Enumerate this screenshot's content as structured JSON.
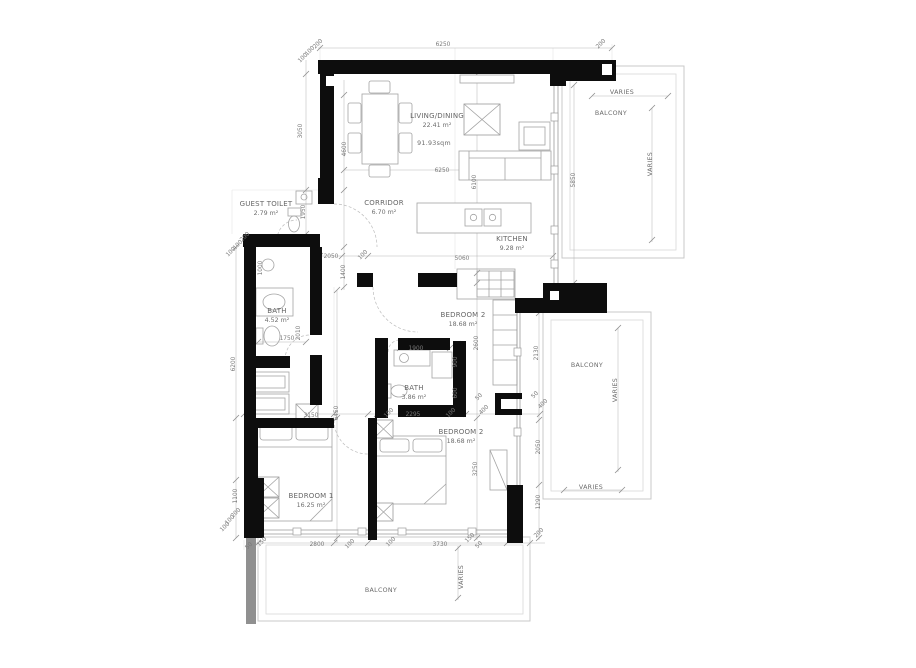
{
  "plan": {
    "title": "apartment-floor-plan",
    "colors": {
      "wall": "#0d0d0d",
      "secondary_wall": "#909090",
      "drawing_line": "#9b9b9b",
      "text": "#6b6b6b",
      "background": "#ffffff"
    },
    "rooms": [
      {
        "id": "living-dining",
        "name": "LIVING/DINING",
        "area": "22.41 m²",
        "x": 437,
        "y": 118
      },
      {
        "id": "corridor",
        "name": "CORRIDOR",
        "area": "6.70 m²",
        "x": 384,
        "y": 205
      },
      {
        "id": "guest-toilet",
        "name": "GUEST TOILET",
        "area": "2.79 m²",
        "x": 266,
        "y": 206
      },
      {
        "id": "kitchen",
        "name": "KITCHEN",
        "area": "9.28 m²",
        "x": 512,
        "y": 241
      },
      {
        "id": "bath-1",
        "name": "BATH",
        "area": "4.52 m²",
        "x": 277,
        "y": 313
      },
      {
        "id": "bath-2",
        "name": "BATH",
        "area": "3.86 m²",
        "x": 414,
        "y": 390
      },
      {
        "id": "bedroom-2-upper",
        "name": "BEDROOM 2",
        "area": "18.68 m²",
        "x": 463,
        "y": 317
      },
      {
        "id": "bedroom-2",
        "name": "BEDROOM 2",
        "area": "18.68 m²",
        "x": 461,
        "y": 434
      },
      {
        "id": "bedroom-1",
        "name": "BEDROOM 1",
        "area": "16.25 m²",
        "x": 311,
        "y": 498
      }
    ],
    "annotations": [
      {
        "id": "total-area",
        "text": "91.93sqm",
        "x": 434,
        "y": 145,
        "r": 0
      },
      {
        "id": "balcony-top-right",
        "text": "BALCONY",
        "x": 611,
        "y": 115,
        "r": 0
      },
      {
        "id": "balcony-right",
        "text": "BALCONY",
        "x": 587,
        "y": 367,
        "r": 0
      },
      {
        "id": "balcony-bottom",
        "text": "BALCONY",
        "x": 381,
        "y": 592,
        "r": 0
      },
      {
        "id": "varies-1",
        "text": "VARIES",
        "x": 622,
        "y": 94,
        "r": 0
      },
      {
        "id": "varies-2",
        "text": "VARIES",
        "x": 652,
        "y": 164,
        "r": -90
      },
      {
        "id": "varies-3",
        "text": "VARIES",
        "x": 617,
        "y": 390,
        "r": -90
      },
      {
        "id": "varies-4",
        "text": "VARIES",
        "x": 591,
        "y": 489,
        "r": 0
      },
      {
        "id": "varies-5",
        "text": "VARIES",
        "x": 463,
        "y": 577,
        "r": -90
      }
    ],
    "dimensions": [
      {
        "t": "200",
        "x": 319,
        "y": 45,
        "r": -45
      },
      {
        "t": "100",
        "x": 311,
        "y": 52,
        "r": -45
      },
      {
        "t": "100",
        "x": 304,
        "y": 59,
        "r": -45
      },
      {
        "t": "6250",
        "x": 443,
        "y": 46,
        "r": 0
      },
      {
        "t": "200",
        "x": 602,
        "y": 45,
        "r": -45
      },
      {
        "t": "3050",
        "x": 302,
        "y": 131,
        "r": -90
      },
      {
        "t": "4600",
        "x": 346,
        "y": 149,
        "r": -90
      },
      {
        "t": "1950",
        "x": 305,
        "y": 212,
        "r": -90
      },
      {
        "t": "6250",
        "x": 442,
        "y": 172,
        "r": 0
      },
      {
        "t": "6100",
        "x": 476,
        "y": 182,
        "r": -90
      },
      {
        "t": "5850",
        "x": 575,
        "y": 180,
        "r": -90
      },
      {
        "t": "200",
        "x": 246,
        "y": 238,
        "r": -45
      },
      {
        "t": "100",
        "x": 239,
        "y": 246,
        "r": -45
      },
      {
        "t": "100",
        "x": 232,
        "y": 253,
        "r": -45
      },
      {
        "t": "2050",
        "x": 331,
        "y": 258,
        "r": 0
      },
      {
        "t": "100",
        "x": 364,
        "y": 256,
        "r": -45
      },
      {
        "t": "5060",
        "x": 462,
        "y": 260,
        "r": 0
      },
      {
        "t": "1400",
        "x": 345,
        "y": 272,
        "r": -90
      },
      {
        "t": "1000",
        "x": 262,
        "y": 268,
        "r": -90
      },
      {
        "t": "1750",
        "x": 287,
        "y": 340,
        "r": 0
      },
      {
        "t": "2010",
        "x": 300,
        "y": 333,
        "r": -90
      },
      {
        "t": "6200",
        "x": 235,
        "y": 364,
        "r": -90
      },
      {
        "t": "1900",
        "x": 416,
        "y": 350,
        "r": 0
      },
      {
        "t": "900",
        "x": 457,
        "y": 362,
        "r": -90
      },
      {
        "t": "600",
        "x": 457,
        "y": 393,
        "r": -90
      },
      {
        "t": "2600",
        "x": 478,
        "y": 343,
        "r": -90
      },
      {
        "t": "2130",
        "x": 538,
        "y": 353,
        "r": -90
      },
      {
        "t": "50",
        "x": 480,
        "y": 398,
        "r": -45
      },
      {
        "t": "400",
        "x": 485,
        "y": 411,
        "r": -45
      },
      {
        "t": "50",
        "x": 536,
        "y": 396,
        "r": -45
      },
      {
        "t": "400",
        "x": 544,
        "y": 405,
        "r": -45
      },
      {
        "t": "3150",
        "x": 311,
        "y": 417,
        "r": 0
      },
      {
        "t": "6450",
        "x": 338,
        "y": 413,
        "r": -90
      },
      {
        "t": "100",
        "x": 390,
        "y": 414,
        "r": -45
      },
      {
        "t": "2295",
        "x": 413,
        "y": 416,
        "r": 0
      },
      {
        "t": "100",
        "x": 452,
        "y": 414,
        "r": -45
      },
      {
        "t": "3250",
        "x": 477,
        "y": 469,
        "r": -90
      },
      {
        "t": "2050",
        "x": 540,
        "y": 447,
        "r": -90
      },
      {
        "t": "1290",
        "x": 540,
        "y": 502,
        "r": -90
      },
      {
        "t": "1100",
        "x": 237,
        "y": 496,
        "r": -90
      },
      {
        "t": "200",
        "x": 237,
        "y": 514,
        "r": -45
      },
      {
        "t": "100",
        "x": 231,
        "y": 521,
        "r": -45
      },
      {
        "t": "100",
        "x": 226,
        "y": 528,
        "r": -45
      },
      {
        "t": "50",
        "x": 250,
        "y": 547,
        "r": -45
      },
      {
        "t": "150",
        "x": 263,
        "y": 543,
        "r": -45
      },
      {
        "t": "2800",
        "x": 317,
        "y": 546,
        "r": 0
      },
      {
        "t": "100",
        "x": 351,
        "y": 545,
        "r": -45
      },
      {
        "t": "100",
        "x": 392,
        "y": 543,
        "r": -45
      },
      {
        "t": "3730",
        "x": 440,
        "y": 546,
        "r": 0
      },
      {
        "t": "150",
        "x": 471,
        "y": 539,
        "r": -45
      },
      {
        "t": "50",
        "x": 480,
        "y": 546,
        "r": -45
      },
      {
        "t": "200",
        "x": 540,
        "y": 534,
        "r": -45
      }
    ]
  }
}
